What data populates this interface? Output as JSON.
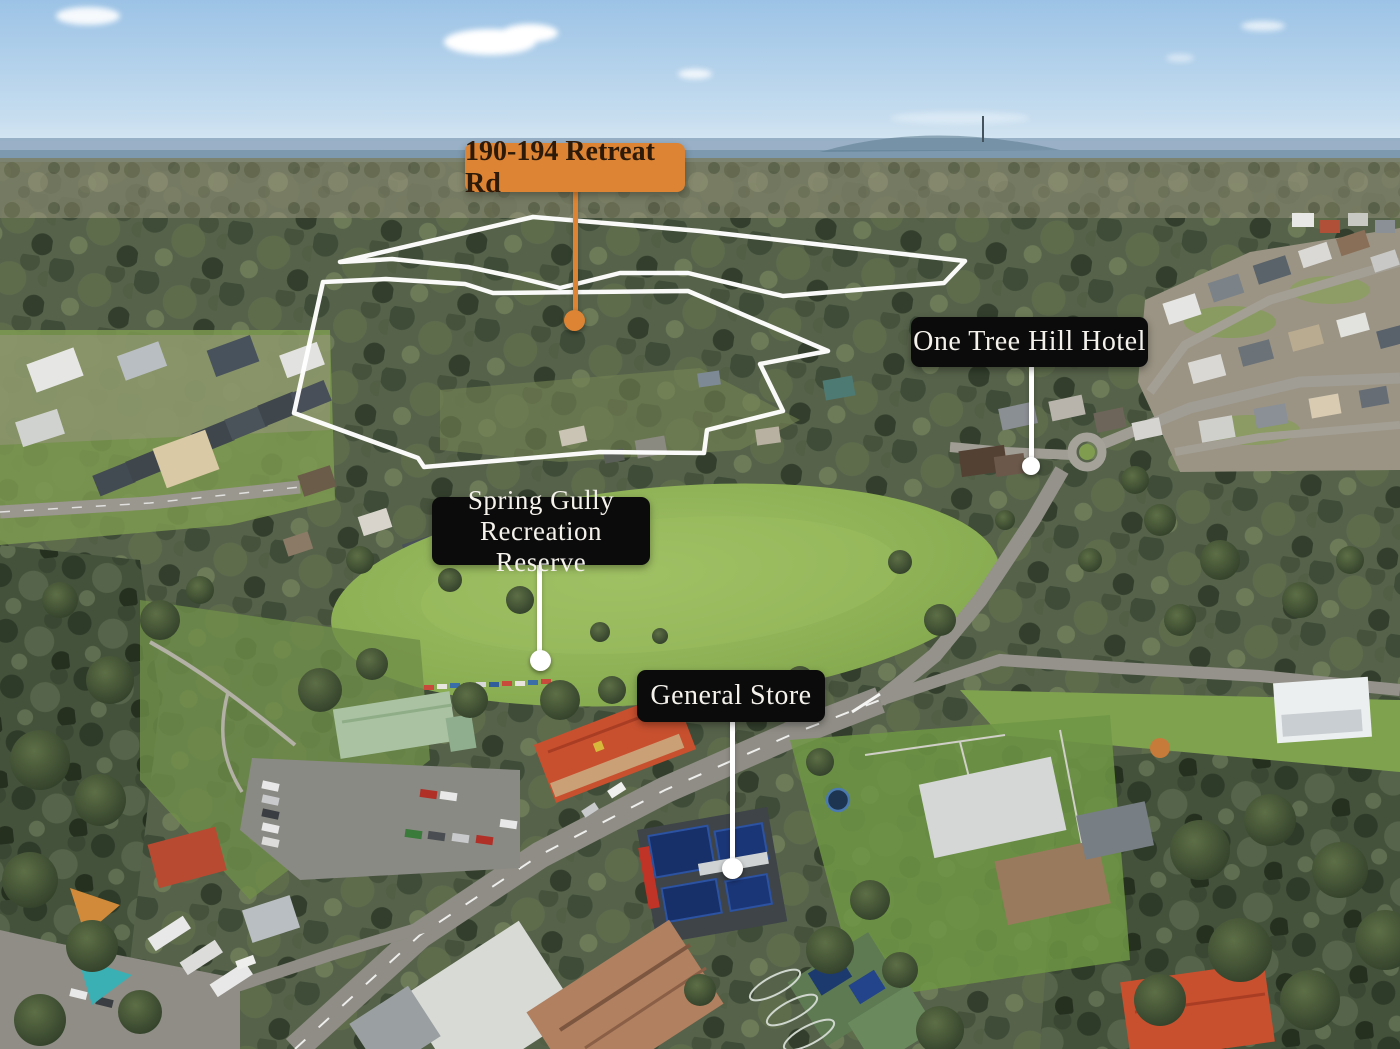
{
  "labels": {
    "property": "190-194 Retreat Rd",
    "hotel": "One Tree Hill Hotel",
    "reserve_line1": "Spring Gully",
    "reserve_line2": "Recreation Reserve",
    "store": "General Store"
  },
  "colors": {
    "property_marker": "#DC8434",
    "property_label_text": "#2E1A08",
    "poi_label_bg": "#0B0B0B",
    "poi_label_text": "#F5F2EC",
    "boundary_stroke": "#FFFFFF"
  }
}
